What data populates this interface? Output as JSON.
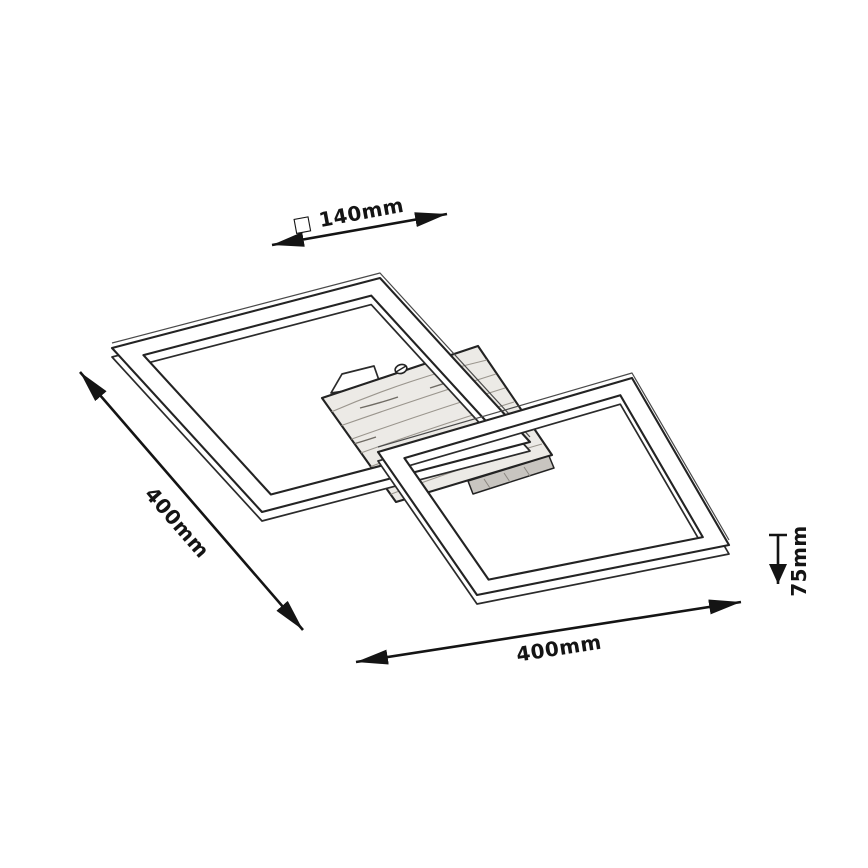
{
  "diagram": {
    "kind": "product-dimension-line-drawing",
    "subject": "ceiling lamp with two crossed square frames and wooden canopy",
    "colors": {
      "background": "#ffffff",
      "line": "#232323",
      "dimension_line": "#141414",
      "wood_fill": "#eceae6",
      "wood_grain": "#9b968e",
      "fold_shade": "#c8c5c0"
    },
    "annotations": [
      {
        "id": "canopy-size",
        "label": "□ 140mm"
      },
      {
        "id": "frame-side",
        "label": "400mm"
      },
      {
        "id": "frame-side-2",
        "label": "400mm"
      },
      {
        "id": "fixture-height",
        "label": "75mm"
      }
    ]
  }
}
